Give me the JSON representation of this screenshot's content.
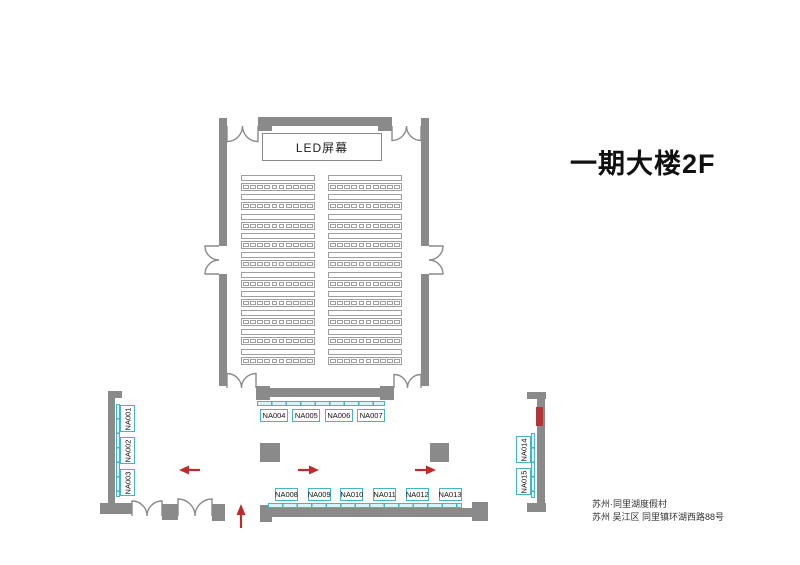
{
  "title": "一期大楼2F",
  "address": {
    "line1": "苏州·同里湖度假村",
    "line2": "苏州 吴江区 同里镇环湖西路88号"
  },
  "hall": {
    "screen_label": "LED屏幕",
    "seating": {
      "columns": 2,
      "rows_per_column": 10,
      "seats_per_row": 10
    }
  },
  "booths": {
    "top_row": [
      "NA004",
      "NA005",
      "NA006",
      "NA007"
    ],
    "bottom_row": [
      "NA008",
      "NA009",
      "NA010",
      "NA011",
      "NA012",
      "NA013"
    ],
    "left_wall": [
      "NA001",
      "NA002",
      "NA003"
    ],
    "right_wall": [
      "NA014",
      "NA015"
    ]
  },
  "arrows": [
    {
      "direction": "left"
    },
    {
      "direction": "right"
    },
    {
      "direction": "right"
    },
    {
      "direction": "up"
    }
  ],
  "colors": {
    "wall": "#8a8a8a",
    "seat_outline": "#9e9e9e",
    "booth_accent": "#45b4c6",
    "arrow_red": "#bf2b2b",
    "marker_red": "#b23434",
    "text": "#111111"
  }
}
